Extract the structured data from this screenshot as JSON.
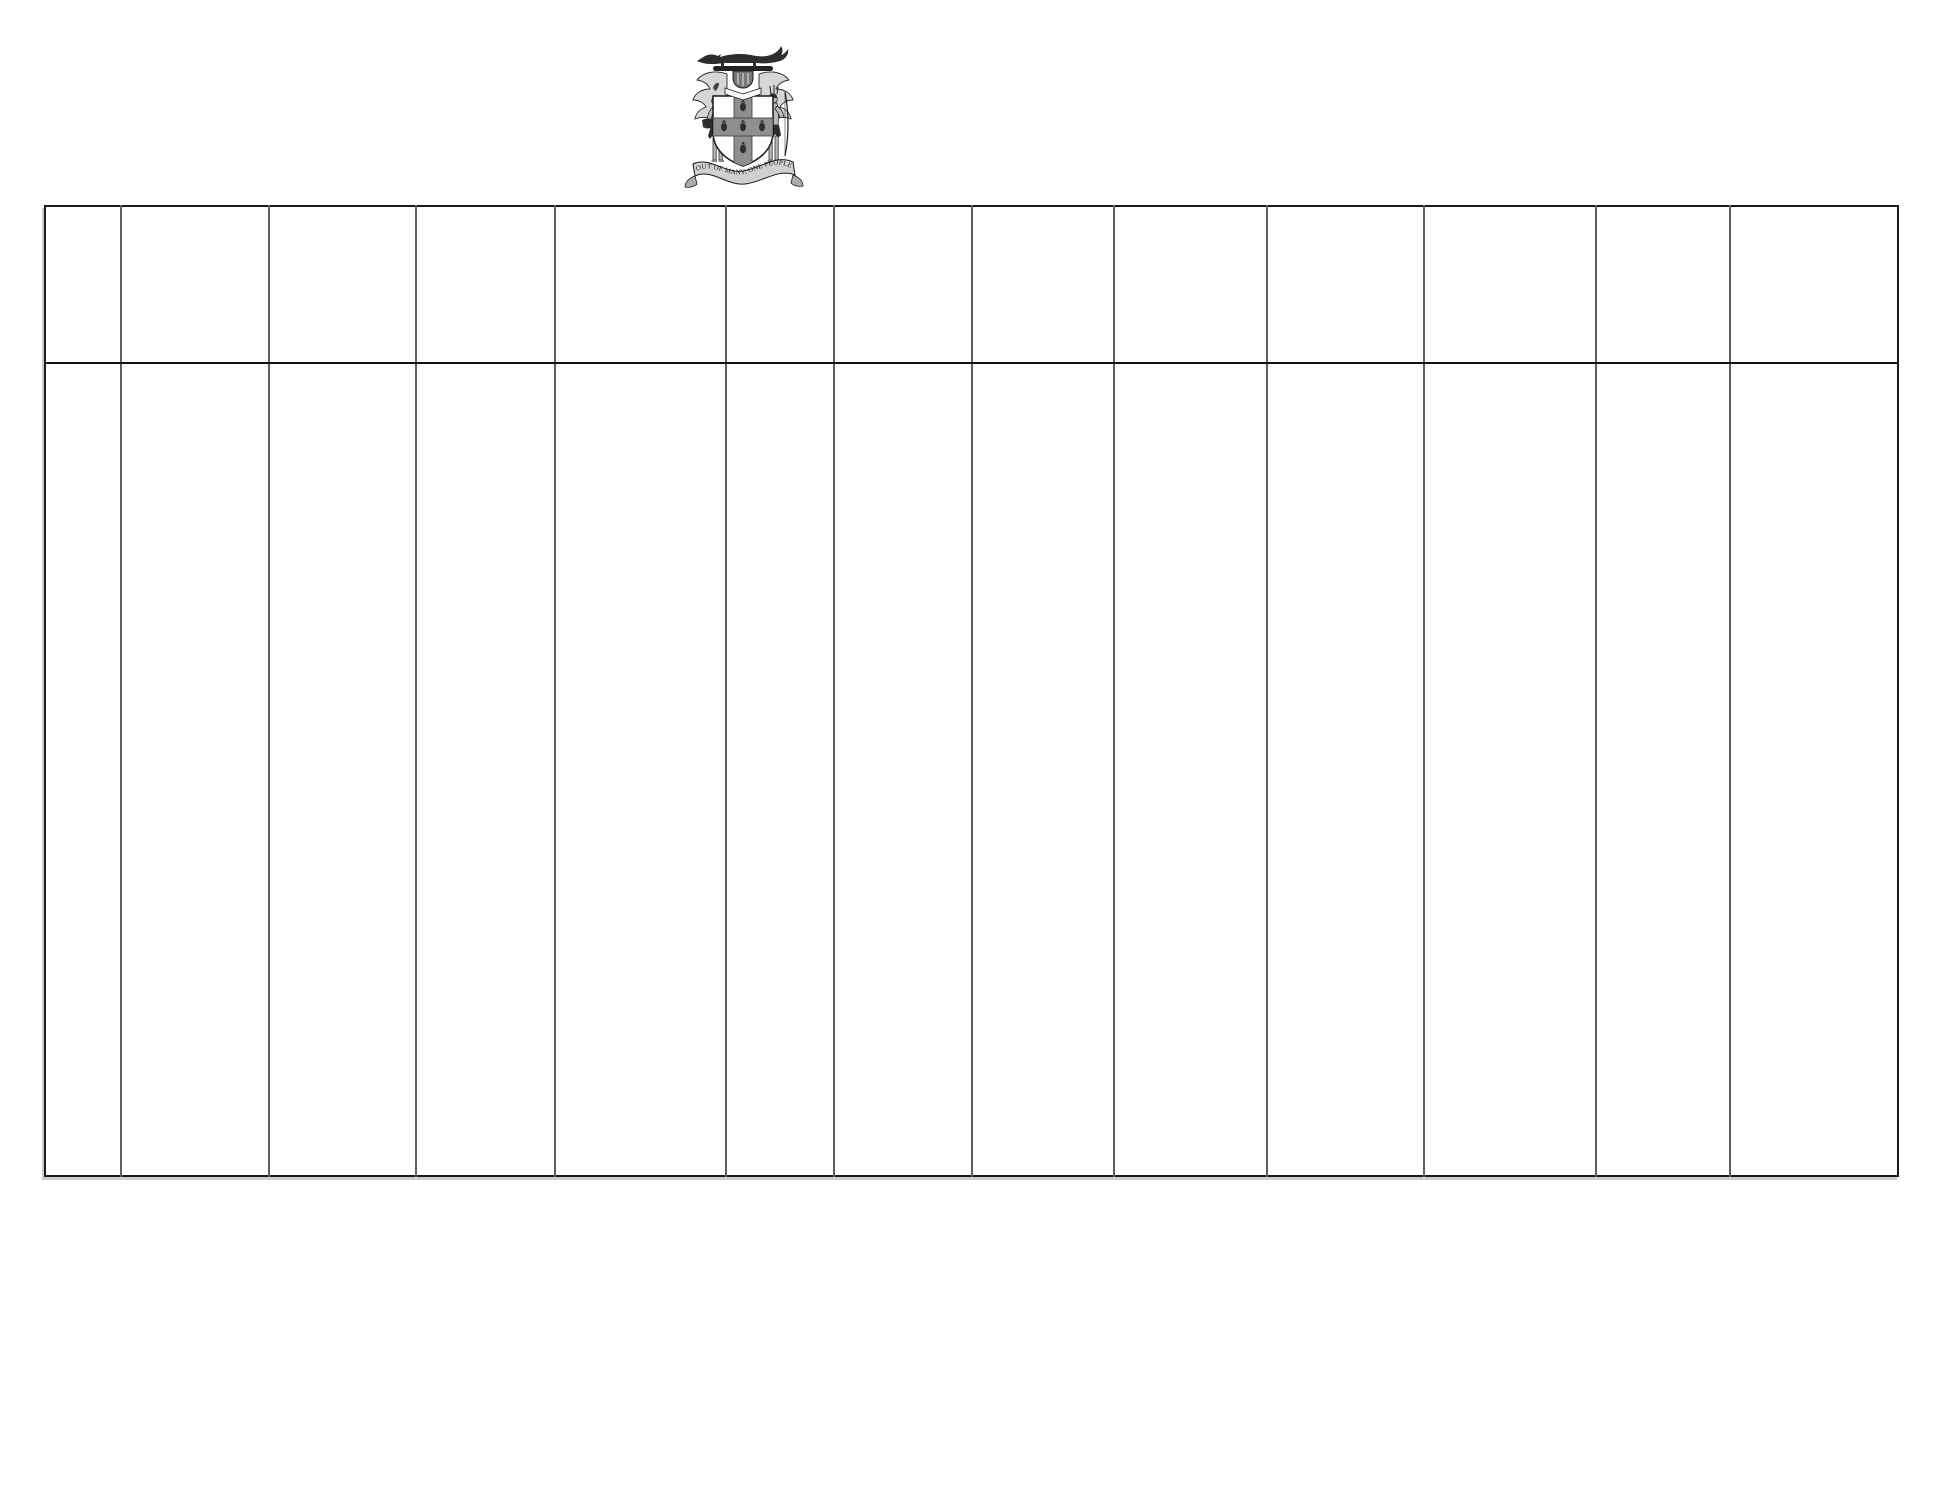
{
  "page": {
    "background_color": "#ffffff",
    "description": "Blank letterhead form page with Jamaica coat of arms and an empty 13-column ruled table"
  },
  "emblem": {
    "icon": "jamaica-coat-of-arms",
    "motto": "OUT OF MANY, ONE PEOPLE",
    "colors": {
      "outline": "#1a1a1a",
      "light_gray": "#d0d0d0",
      "mid_gray": "#8f8f8f",
      "dark": "#2d2d2d"
    }
  },
  "table": {
    "column_count": 13,
    "column_widths_px": [
      76,
      148,
      147,
      139,
      171,
      108,
      138,
      142,
      153,
      157,
      172,
      134,
      168
    ],
    "header_cells": [
      "",
      "",
      "",
      "",
      "",
      "",
      "",
      "",
      "",
      "",
      "",
      "",
      ""
    ],
    "rows": [
      [
        "",
        "",
        "",
        "",
        "",
        "",
        "",
        "",
        "",
        "",
        "",
        "",
        ""
      ]
    ],
    "borders": {
      "outer": "#1b1b1b",
      "inner_vertical": "#5f5f5f",
      "header_separator": "#121212"
    }
  }
}
